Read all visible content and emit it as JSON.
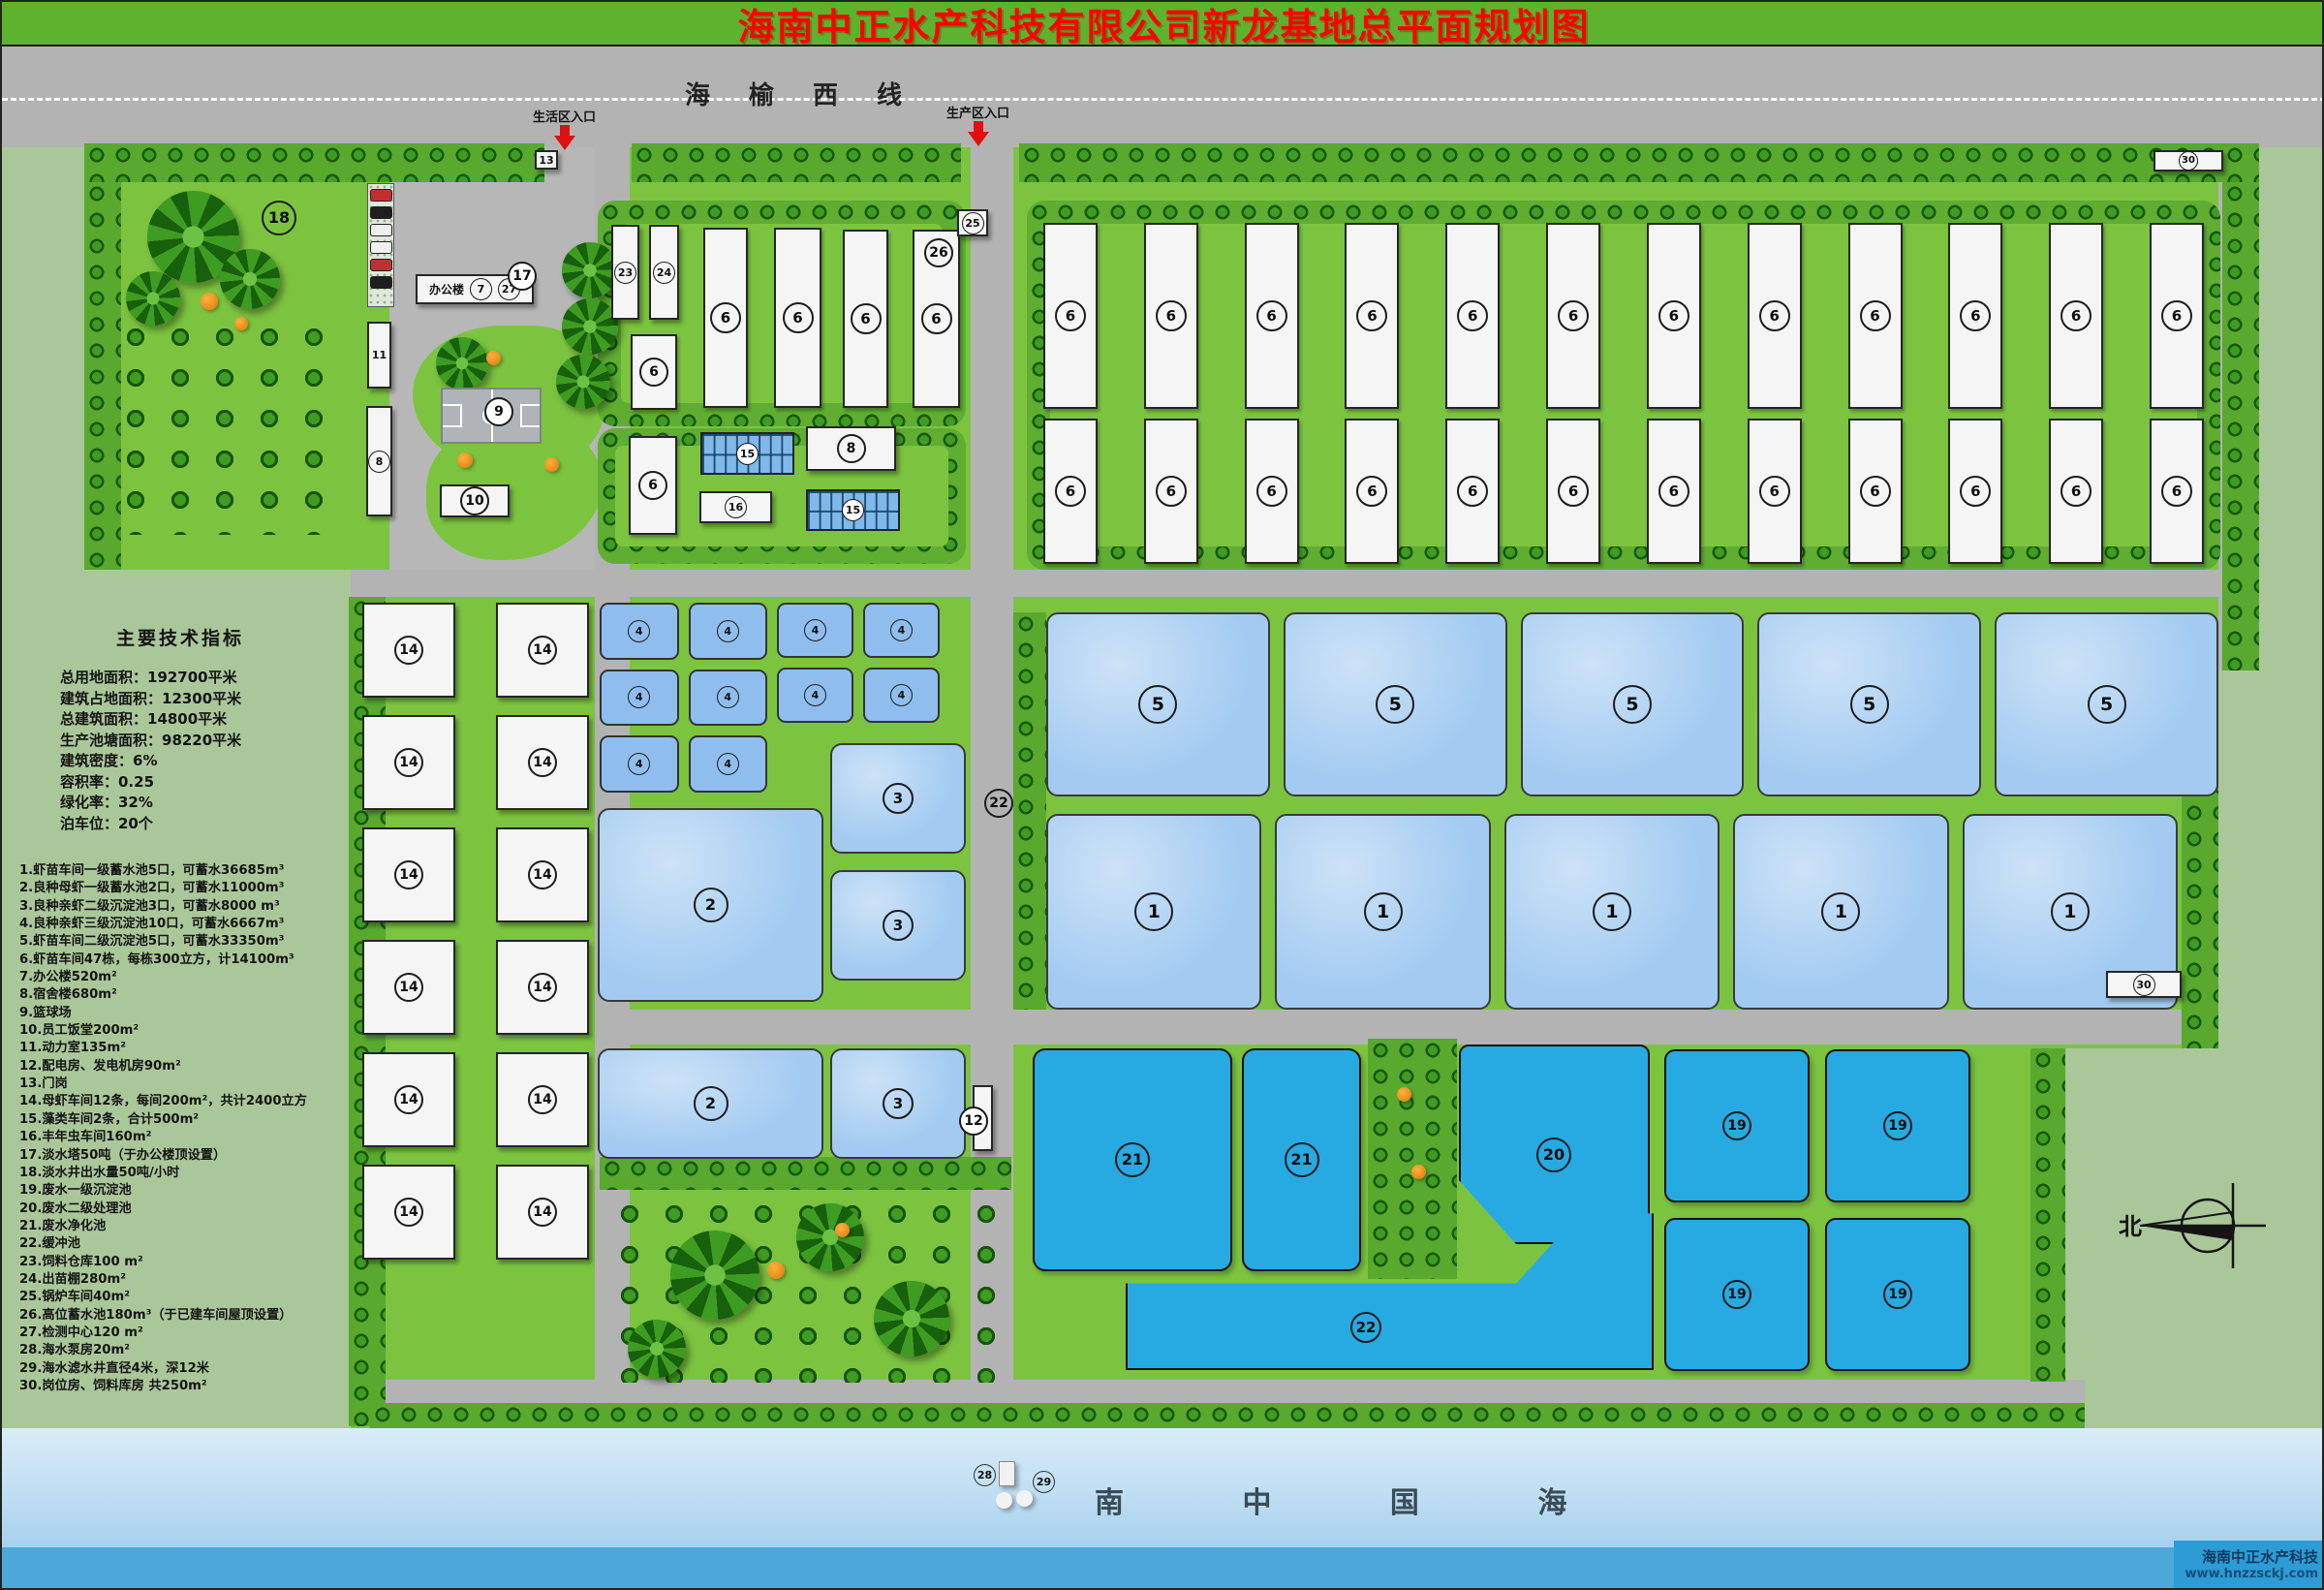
{
  "title": "海南中正水产科技有限公司新龙基地总平面规划图",
  "highway": {
    "name": "海榆西线",
    "entrance_living": "生活区入口",
    "entrance_production": "生产区入口"
  },
  "indicators": {
    "title": "主要技术指标",
    "lines": [
      "总用地面积：192700平米",
      "建筑占地面积：12300平米",
      "总建筑面积：14800平米",
      "生产池塘面积：98220平米",
      "建筑密度：6%",
      "容积率：0.25",
      "绿化率：32%",
      "泊车位：20个"
    ]
  },
  "legend": {
    "lines": [
      "1.虾苗车间一级蓄水池5口，可蓄水36685m³",
      "2.良种母虾一级蓄水池2口，可蓄水11000m³",
      "3.良种亲虾二级沉淀池3口，可蓄水8000 m³",
      "4.良种亲虾三级沉淀池10口，可蓄水6667m³",
      "5.虾苗车间二级沉淀池5口，可蓄水33350m³",
      "6.虾苗车间47栋，每栋300立方，计14100m³",
      "7.办公楼520m²",
      "8.宿舍楼680m²",
      "9.篮球场",
      "10.员工饭堂200m²",
      "11.动力室135m²",
      "12.配电房、发电机房90m²",
      "13.门岗",
      "14.母虾车间12条，每间200m²，共计2400立方",
      "15.藻类车间2条，合计500m²",
      "16.丰年虫车间160m²",
      "17.淡水塔50吨（于办公楼顶设置）",
      "18.淡水井出水量50吨/小时",
      "19.废水一级沉淀池",
      "20.废水二级处理池",
      "21.废水净化池",
      "22.缓冲池",
      "23.饲料仓库100 m²",
      "24.出苗棚280m²",
      "25.锅炉车间40m²",
      "26.高位蓄水池180m³（于已建车间屋顶设置）",
      "27.检测中心120 m²",
      "28.海水泵房20m²",
      "29.海水滤水井直径4米，深12米",
      "30.岗位房、饲料库房 共250m²"
    ]
  },
  "buildings": {
    "office": "办公楼"
  },
  "badges": {
    "n2": "2",
    "n3": "3",
    "n6": "6",
    "n7": "7",
    "n8": "8",
    "n9": "9",
    "n10": "10",
    "n11": "11",
    "n12": "12",
    "n13": "13",
    "n15": "15",
    "n16": "16",
    "n17": "17",
    "n18": "18",
    "n20": "20",
    "n21": "21",
    "n22": "22",
    "n23": "23",
    "n24": "24",
    "n25": "25",
    "n26": "26",
    "n27": "27",
    "n28": "28",
    "n29": "29",
    "n30": "30"
  },
  "repeat": {
    "sheds_row1": [
      "6",
      "6",
      "6",
      "6",
      "6",
      "6",
      "6",
      "6",
      "6",
      "6",
      "6",
      "6"
    ],
    "sheds_row2": [
      "6",
      "6",
      "6",
      "6",
      "6",
      "6",
      "6",
      "6",
      "6",
      "6",
      "6",
      "6"
    ],
    "ponds5": [
      "5",
      "5",
      "5",
      "5",
      "5"
    ],
    "ponds1": [
      "1",
      "1",
      "1",
      "1",
      "1"
    ],
    "ponds4a": [
      "4",
      "4",
      "4",
      "4",
      "4",
      "4"
    ],
    "ponds4b": [
      "4",
      "4",
      "4",
      "4"
    ],
    "b14": [
      "14",
      "14",
      "14",
      "14",
      "14",
      "14",
      "14",
      "14",
      "14",
      "14",
      "14",
      "14"
    ],
    "ponds19": [
      "19",
      "19",
      "19",
      "19"
    ]
  },
  "sea": {
    "name": "南  中  国  海",
    "brand": "海南中正水产科技",
    "site": "www.hnzzsckj.com"
  },
  "compass": {
    "north": "北"
  }
}
